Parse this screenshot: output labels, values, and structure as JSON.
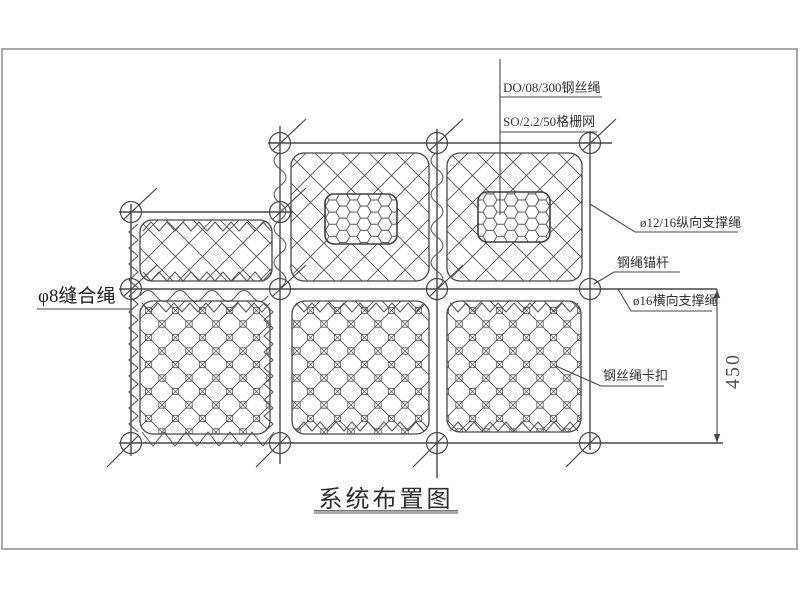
{
  "drawing": {
    "title": "系统布置图",
    "labels": {
      "wire_rope_net": "DO/08/300钢丝绳",
      "grid_mesh": "SO/2.2/50格栅网",
      "longitudinal_support_rope": "ø12/16纵向支撑绳",
      "anchor_rod": "钢绳锚杆",
      "transverse_support_rope": "ø16横向支撑绳",
      "wire_rope_clip": "钢丝绳卡扣",
      "seam_rope": "φ8缝合绳"
    },
    "dimension_450": "450",
    "colors": {
      "line": "#474747",
      "frame": "#8c8c8c",
      "title_underline": "#aaaaaa",
      "background": "#ffffff"
    }
  }
}
